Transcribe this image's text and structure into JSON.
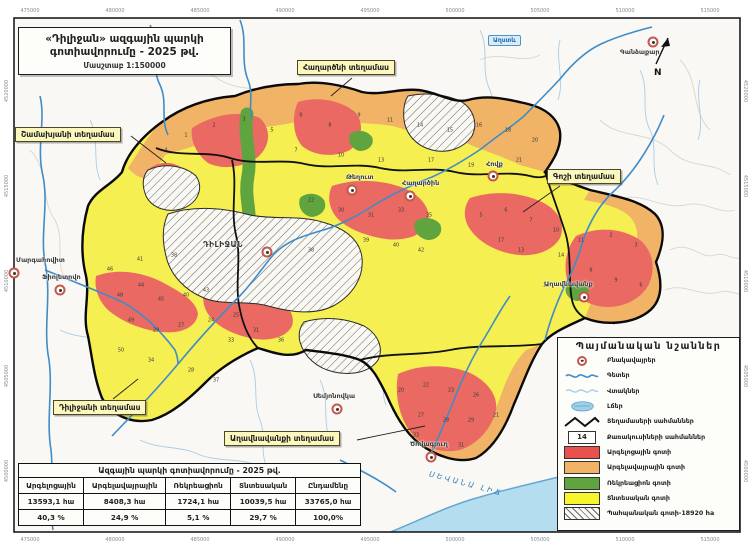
{
  "title_box": {
    "line1": "«Դիլիջան» ազգային պարկի",
    "line2": "գոտիավորումը - 2025 թվ.",
    "scale": "Մասշտաբ 1:150000"
  },
  "north_label": "N",
  "grid": {
    "top": [
      "475000",
      "480000",
      "485000",
      "490000",
      "495000",
      "500000",
      "505000",
      "510000",
      "515000"
    ],
    "bottom": [
      "475000",
      "480000",
      "485000",
      "490000",
      "495000",
      "500000",
      "505000",
      "510000",
      "515000"
    ],
    "left": [
      "4520000",
      "4515000",
      "4510000",
      "4505000",
      "4500000"
    ],
    "right": [
      "4520000",
      "4515000",
      "4510000",
      "4505000",
      "4500000"
    ]
  },
  "map_labels": {
    "lake": "ՍԵՎԱՆԱ ԼԻՃ",
    "river": "Աղստև"
  },
  "sections": [
    {
      "label": "Շամախյանի տեղամաս",
      "x": 15,
      "y": 127
    },
    {
      "label": "Հաղարծնի տեղամաս",
      "x": 297,
      "y": 60
    },
    {
      "label": "Գոշի տեղամաս",
      "x": 547,
      "y": 169
    },
    {
      "label": "Դիլիջանի տեղամաս",
      "x": 53,
      "y": 400
    },
    {
      "label": "Աղավնավանքի տեղամաս",
      "x": 224,
      "y": 431
    }
  ],
  "settlements": [
    {
      "name": "Գանձաքար",
      "tx": 620,
      "ty": 48,
      "dx": 653,
      "dy": 42
    },
    {
      "name": "Հովք",
      "tx": 486,
      "ty": 160,
      "dx": 493,
      "dy": 176
    },
    {
      "name": "Թեղուտ",
      "tx": 346,
      "ty": 173,
      "dx": 352,
      "dy": 190
    },
    {
      "name": "Հաղարծին",
      "tx": 402,
      "ty": 179,
      "dx": 410,
      "dy": 196
    },
    {
      "name": "ԴԻԼԻՋԱՆ",
      "tx": 203,
      "ty": 240,
      "dx": 267,
      "dy": 252,
      "city": true
    },
    {
      "name": "Մարգահովիտ",
      "tx": 16,
      "ty": 256,
      "dx": 14,
      "dy": 273
    },
    {
      "name": "Ֆիոլետովո",
      "tx": 42,
      "ty": 273,
      "dx": 60,
      "dy": 290
    },
    {
      "name": "Աղավնավանք",
      "tx": 544,
      "ty": 280,
      "dx": 584,
      "dy": 297
    },
    {
      "name": "Սեմյոնովկա",
      "tx": 313,
      "ty": 392,
      "dx": 337,
      "dy": 409
    },
    {
      "name": "Ծովագյուղ",
      "tx": 410,
      "ty": 440,
      "dx": 431,
      "dy": 457
    }
  ],
  "quadrats": [
    {
      "n": "1",
      "x": 186,
      "y": 136
    },
    {
      "n": "2",
      "x": 214,
      "y": 126
    },
    {
      "n": "3",
      "x": 244,
      "y": 120
    },
    {
      "n": "5",
      "x": 272,
      "y": 131
    },
    {
      "n": "6",
      "x": 301,
      "y": 116
    },
    {
      "n": "8",
      "x": 330,
      "y": 126
    },
    {
      "n": "9",
      "x": 359,
      "y": 116
    },
    {
      "n": "11",
      "x": 390,
      "y": 121
    },
    {
      "n": "14",
      "x": 420,
      "y": 126
    },
    {
      "n": "15",
      "x": 450,
      "y": 131
    },
    {
      "n": "16",
      "x": 479,
      "y": 126
    },
    {
      "n": "18",
      "x": 508,
      "y": 131
    },
    {
      "n": "20",
      "x": 535,
      "y": 141
    },
    {
      "n": "4",
      "x": 166,
      "y": 151
    },
    {
      "n": "7",
      "x": 296,
      "y": 151
    },
    {
      "n": "10",
      "x": 341,
      "y": 156
    },
    {
      "n": "13",
      "x": 381,
      "y": 161
    },
    {
      "n": "17",
      "x": 431,
      "y": 161
    },
    {
      "n": "19",
      "x": 471,
      "y": 166
    },
    {
      "n": "21",
      "x": 519,
      "y": 161
    },
    {
      "n": "46",
      "x": 110,
      "y": 270
    },
    {
      "n": "41",
      "x": 140,
      "y": 260
    },
    {
      "n": "38",
      "x": 174,
      "y": 256
    },
    {
      "n": "48",
      "x": 120,
      "y": 296
    },
    {
      "n": "44",
      "x": 141,
      "y": 286
    },
    {
      "n": "45",
      "x": 161,
      "y": 300
    },
    {
      "n": "40",
      "x": 186,
      "y": 296
    },
    {
      "n": "43",
      "x": 206,
      "y": 291
    },
    {
      "n": "49",
      "x": 131,
      "y": 321
    },
    {
      "n": "29",
      "x": 156,
      "y": 331
    },
    {
      "n": "27",
      "x": 181,
      "y": 326
    },
    {
      "n": "24",
      "x": 211,
      "y": 321
    },
    {
      "n": "25",
      "x": 236,
      "y": 316
    },
    {
      "n": "33",
      "x": 231,
      "y": 341
    },
    {
      "n": "31",
      "x": 256,
      "y": 331
    },
    {
      "n": "36",
      "x": 281,
      "y": 341
    },
    {
      "n": "50",
      "x": 121,
      "y": 351
    },
    {
      "n": "34",
      "x": 151,
      "y": 361
    },
    {
      "n": "28",
      "x": 191,
      "y": 371
    },
    {
      "n": "37",
      "x": 216,
      "y": 381
    },
    {
      "n": "22",
      "x": 311,
      "y": 201
    },
    {
      "n": "30",
      "x": 341,
      "y": 211
    },
    {
      "n": "31",
      "x": 371,
      "y": 216
    },
    {
      "n": "33",
      "x": 401,
      "y": 211
    },
    {
      "n": "35",
      "x": 429,
      "y": 216
    },
    {
      "n": "39",
      "x": 366,
      "y": 241
    },
    {
      "n": "40",
      "x": 396,
      "y": 246
    },
    {
      "n": "42",
      "x": 421,
      "y": 251
    },
    {
      "n": "38",
      "x": 311,
      "y": 251
    },
    {
      "n": "5",
      "x": 481,
      "y": 216
    },
    {
      "n": "6",
      "x": 506,
      "y": 211
    },
    {
      "n": "7",
      "x": 531,
      "y": 221
    },
    {
      "n": "10",
      "x": 556,
      "y": 231
    },
    {
      "n": "11",
      "x": 581,
      "y": 241
    },
    {
      "n": "2",
      "x": 611,
      "y": 236
    },
    {
      "n": "3",
      "x": 636,
      "y": 246
    },
    {
      "n": "8",
      "x": 591,
      "y": 271
    },
    {
      "n": "9",
      "x": 616,
      "y": 281
    },
    {
      "n": "6",
      "x": 641,
      "y": 286
    },
    {
      "n": "14",
      "x": 561,
      "y": 256
    },
    {
      "n": "12",
      "x": 546,
      "y": 286
    },
    {
      "n": "13",
      "x": 521,
      "y": 251
    },
    {
      "n": "17",
      "x": 501,
      "y": 241
    },
    {
      "n": "20",
      "x": 401,
      "y": 391
    },
    {
      "n": "22",
      "x": 426,
      "y": 386
    },
    {
      "n": "23",
      "x": 451,
      "y": 391
    },
    {
      "n": "26",
      "x": 476,
      "y": 396
    },
    {
      "n": "27",
      "x": 421,
      "y": 416
    },
    {
      "n": "28",
      "x": 446,
      "y": 421
    },
    {
      "n": "29",
      "x": 471,
      "y": 421
    },
    {
      "n": "21",
      "x": 496,
      "y": 416
    },
    {
      "n": "34",
      "x": 436,
      "y": 446
    },
    {
      "n": "31",
      "x": 461,
      "y": 446
    },
    {
      "n": "33",
      "x": 416,
      "y": 436
    }
  ],
  "legend": {
    "title": "Պայմանական նշաններ",
    "items": [
      {
        "icon": "settlement-icon",
        "label": "Բնակավայրեր"
      },
      {
        "icon": "river-line-icon",
        "label": "Գետեր"
      },
      {
        "icon": "tributary-line-icon",
        "label": "Վտակներ"
      },
      {
        "icon": "lake-icon",
        "label": "Լճեր"
      },
      {
        "icon": "section-boundary-icon",
        "label": "Տեղամասերի սահմաններ"
      },
      {
        "icon": "quadrat-box-icon",
        "value": "14",
        "label": "Քառակուսիների սահմաններ"
      },
      {
        "icon": "zone-swatch-icon",
        "color": "#e8514d",
        "label": "Արգելոցային գոտի"
      },
      {
        "icon": "zone-swatch-icon",
        "color": "#f1b366",
        "label": "Արգելավայրային գոտի"
      },
      {
        "icon": "zone-swatch-icon",
        "color": "#5fa43e",
        "label": "Ռեկրեացիոն գոտի"
      },
      {
        "icon": "zone-swatch-icon",
        "color": "#f7f52b",
        "label": "Տնտեսական գոտի"
      },
      {
        "icon": "hatch-swatch-icon",
        "label": "Պահպանական գոտի-18920 ha"
      }
    ]
  },
  "table": {
    "title": "Ազգային պարկի գոտիավորումը - 2025 թվ.",
    "columns": [
      {
        "header": "Արգելոցային",
        "area": "13593,1 հա",
        "percent": "40,3 %"
      },
      {
        "header": "Արգելավայրային",
        "area": "8408,3 հա",
        "percent": "24,9 %",
        "wide": true
      },
      {
        "header": "Ռեկրեացիոն",
        "area": "1724,1 հա",
        "percent": "5,1 %"
      },
      {
        "header": "Տնտեսական",
        "area": "10039,5 հա",
        "percent": "29,7 %"
      },
      {
        "header": "Ընդամենը",
        "area": "33765,0 հա",
        "percent": "100,0%"
      }
    ]
  },
  "colors": {
    "reserve_zone": "#ea6a63",
    "sanctuary_zone": "#f1b366",
    "recreation_zone": "#5fa43e",
    "economic_zone": "#f5ef52",
    "river": "#3f8cc8",
    "lake": "#b5ddf0"
  }
}
